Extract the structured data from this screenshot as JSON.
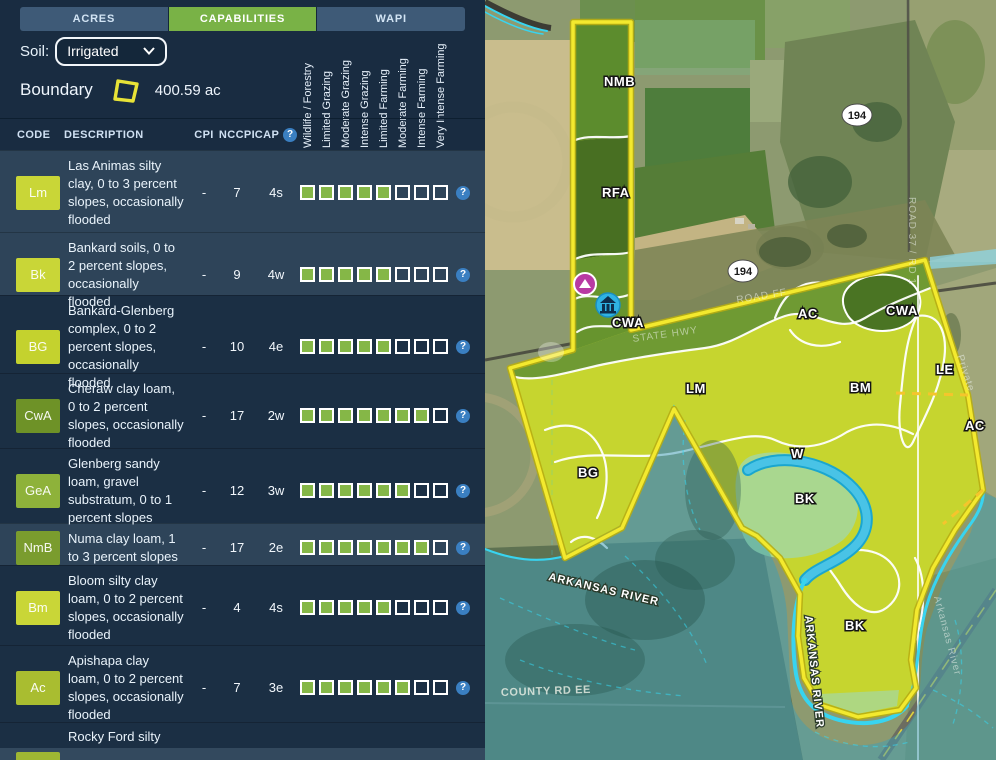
{
  "tabs": [
    {
      "label": "ACRES",
      "active": false
    },
    {
      "label": "CAPABILITIES",
      "active": true
    },
    {
      "label": "WAPI",
      "active": false
    }
  ],
  "soil": {
    "label": "Soil:",
    "selected": "Irrigated"
  },
  "boundary": {
    "label": "Boundary",
    "area": "400.59 ac"
  },
  "icons": {
    "help_glyph": "?"
  },
  "table": {
    "headers": {
      "code": "CODE",
      "description": "DESCRIPTION",
      "cpi": "CPI",
      "nccpi": "NCCPI",
      "cap": "CAP"
    },
    "capability_columns": [
      "Wildlife / Forestry",
      "Limited Grazing",
      "Moderate Grazing",
      "Intense Grazing",
      "Limited Farming",
      "Moderate Farming",
      "Intense Farming",
      "Very Intense Farming"
    ],
    "capability_scale": 8,
    "rows": [
      {
        "code": "Lm",
        "code_color": "#c9d637",
        "description": "Las Animas silty clay, 0 to 3 percent slopes, occasionally flooded",
        "cpi": "-",
        "nccpi": "7",
        "cap": "4s",
        "filled": 5,
        "shade": "light",
        "height": 82
      },
      {
        "code": "Bk",
        "code_color": "#c9d637",
        "description": "Bankard soils, 0 to 2 percent slopes, occasionally flooded",
        "cpi": "-",
        "nccpi": "9",
        "cap": "4w",
        "filled": 5,
        "shade": "light",
        "height": 63
      },
      {
        "code": "BG",
        "code_color": "#c4d22e",
        "description": "Bankard-Glenberg complex, 0 to 2 percent slopes, occasionally flooded",
        "cpi": "-",
        "nccpi": "10",
        "cap": "4e",
        "filled": 5,
        "shade": "dark",
        "height": 78
      },
      {
        "code": "CwA",
        "code_color": "#6e9227",
        "description": "Cheraw clay loam, 0 to 2 percent slopes, occasionally flooded",
        "cpi": "-",
        "nccpi": "17",
        "cap": "2w",
        "filled": 7,
        "shade": "dark",
        "height": 75
      },
      {
        "code": "GeA",
        "code_color": "#8eb23a",
        "description": "Glenberg sandy loam, gravel substratum, 0 to 1 percent slopes",
        "cpi": "-",
        "nccpi": "12",
        "cap": "3w",
        "filled": 6,
        "shade": "dark",
        "height": 75
      },
      {
        "code": "NmB",
        "code_color": "#7a9c2e",
        "description": "Numa clay loam, 1 to 3 percent slopes",
        "cpi": "-",
        "nccpi": "17",
        "cap": "2e",
        "filled": 7,
        "shade": "light",
        "height": 42
      },
      {
        "code": "Bm",
        "code_color": "#c9d637",
        "description": "Bloom silty clay loam, 0 to 2 percent slopes, occasionally flooded",
        "cpi": "-",
        "nccpi": "4",
        "cap": "4s",
        "filled": 5,
        "shade": "dark",
        "height": 80
      },
      {
        "code": "Ac",
        "code_color": "#a9bd30",
        "description": "Apishapa clay loam, 0 to 2 percent slopes, occasionally flooded",
        "cpi": "-",
        "nccpi": "7",
        "cap": "3e",
        "filled": 6,
        "shade": "dark",
        "height": 77
      },
      {
        "code": "",
        "code_color": "",
        "description": "Rocky Ford silty clay loam, 0 to 1",
        "cpi": "",
        "nccpi": "",
        "cap": "",
        "filled": 0,
        "shade": "dark",
        "height": 26,
        "clipped": true
      }
    ]
  },
  "map": {
    "region_labels": [
      {
        "code": "NMB",
        "x": 119,
        "y": 86
      },
      {
        "code": "RFA",
        "x": 117,
        "y": 197
      },
      {
        "code": "CWA",
        "x": 127,
        "y": 327
      },
      {
        "code": "AC",
        "x": 313,
        "y": 318
      },
      {
        "code": "CWA",
        "x": 401,
        "y": 315
      },
      {
        "code": "LE",
        "x": 451,
        "y": 374
      },
      {
        "code": "LM",
        "x": 201,
        "y": 393
      },
      {
        "code": "BM",
        "x": 365,
        "y": 392
      },
      {
        "code": "AC",
        "x": 480,
        "y": 430
      },
      {
        "code": "BG",
        "x": 93,
        "y": 477
      },
      {
        "code": "W",
        "x": 306,
        "y": 458
      },
      {
        "code": "BK",
        "x": 310,
        "y": 503
      },
      {
        "code": "BK",
        "x": 360,
        "y": 630
      }
    ],
    "highway_shields": [
      {
        "label": "194",
        "x": 372,
        "y": 115
      },
      {
        "label": "194",
        "x": 258,
        "y": 271
      }
    ],
    "road_labels": [
      {
        "text": "ROAD 37 / RD 1",
        "x": 424,
        "y": 197,
        "rotate": 90,
        "style": "faint"
      },
      {
        "text": "STATE HWY",
        "x": 148,
        "y": 342,
        "rotate": -8,
        "style": "faint"
      },
      {
        "text": "ROAD FF",
        "x": 252,
        "y": 303,
        "rotate": -9,
        "style": "faint"
      },
      {
        "text": "Private",
        "x": 472,
        "y": 356,
        "rotate": 72,
        "style": "faint"
      },
      {
        "text": "ARKANSAS RIVER",
        "x": 63,
        "y": 580,
        "rotate": 13,
        "style": "halo"
      },
      {
        "text": "ARKANSAS RIVER",
        "x": 320,
        "y": 616,
        "rotate": 84,
        "style": "halo"
      },
      {
        "text": "Arkansas River",
        "x": 449,
        "y": 597,
        "rotate": 75,
        "style": "faint"
      },
      {
        "text": "COUNTY RD EE",
        "x": 16,
        "y": 696,
        "rotate": -2,
        "style": "dim"
      }
    ],
    "markers": [
      {
        "name": "campground-marker",
        "x": 100,
        "y": 284,
        "color": "#b83aa3"
      },
      {
        "name": "building-marker",
        "x": 123,
        "y": 305,
        "color": "#2fb3e3"
      }
    ],
    "colors": {
      "boundary": "#f3e92e",
      "soil_bright": "#c6d52f",
      "soil_olive": "#6f9a33",
      "soil_dark_green": "#4a7423",
      "soil_mint": "#a9d78f",
      "water": "#49c3e6",
      "flood_overlay": "#3f9db6"
    }
  }
}
